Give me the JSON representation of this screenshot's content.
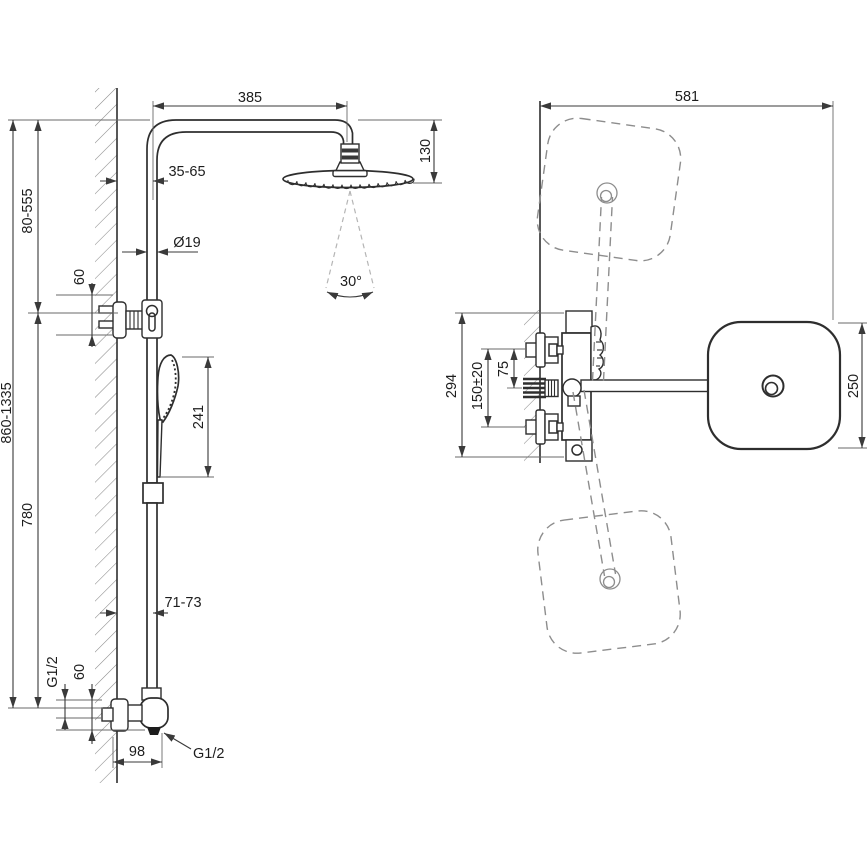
{
  "title": "Shower column technical drawing",
  "colors": {
    "line": "#2e2e2e",
    "dimension": "#3a3a3a",
    "dashed": "#8d8d8d",
    "background": "#ffffff"
  },
  "front": {
    "arm_length": "385",
    "head_height": "130",
    "wall_to_column_top": "35-65",
    "column_diameter": "Ø19",
    "bracket_offset": "60",
    "bracket_height_range": "80-555",
    "total_height_range": "860-1335",
    "bar_length": "780",
    "spray_angle": "30°",
    "hand_shower_length": "241",
    "wall_to_column_bottom": "71-73",
    "inlet_thread": "G1/2",
    "inlet_offset": "60",
    "mixer_depth": "98",
    "outlet_thread": "G1/2"
  },
  "side": {
    "total_reach": "581",
    "mixer_height": "294",
    "inlet_spacing": "150±20",
    "handle_to_arm": "75",
    "head_width": "250"
  }
}
